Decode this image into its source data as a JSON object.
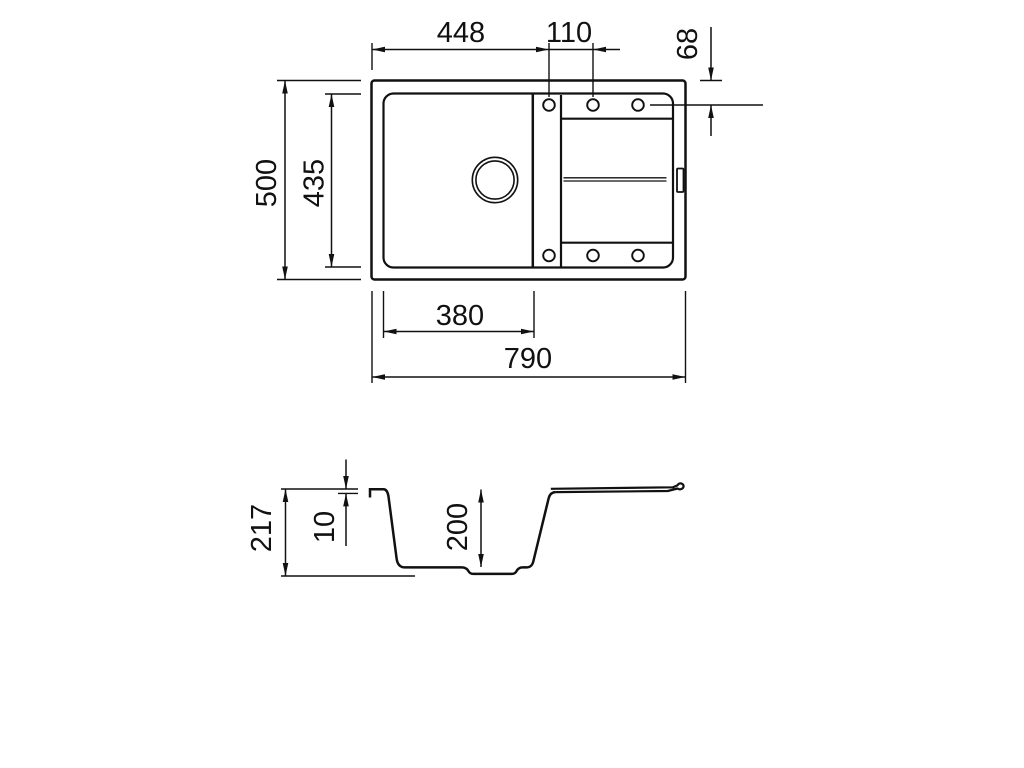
{
  "page": {
    "background": "#ffffff",
    "line_color": "#111111"
  },
  "drawing": {
    "kind": "sink-dimension-drawing",
    "dimensions_mm": {
      "tap_hole_offset_from_left": "448",
      "tap_hole_spacing": "110",
      "tap_hole_offset_from_top": "68",
      "overall_depth": "500",
      "inner_depth": "435",
      "bowl_width": "380",
      "overall_length": "790",
      "overall_height": "217",
      "rim_height": "10",
      "bowl_depth": "200"
    }
  }
}
